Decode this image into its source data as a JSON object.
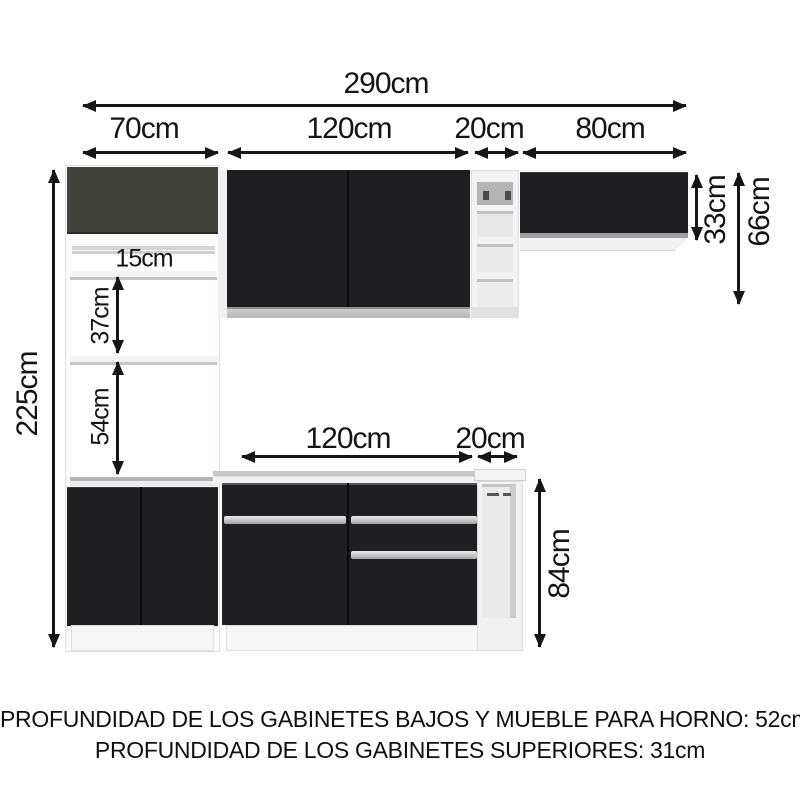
{
  "dims": {
    "total_width": "290cm",
    "tall_cabinet_width": "70cm",
    "wall_cabinet_width": "120cm",
    "upper_shelf_width": "20cm",
    "right_cabinet_width": "80cm",
    "total_height": "225cm",
    "right_cabinet_height": "33cm",
    "upper_zone_height": "66cm",
    "shelf_gap_top": "15cm",
    "shelf_gap_mid": "37cm",
    "shelf_gap_bottom": "54cm",
    "base_cabinet_width": "120cm",
    "base_shelf_width": "20cm",
    "base_height": "84cm"
  },
  "notes": {
    "line1": "PROFUNDIDAD DE LOS GABINETES BAJOS Y MUEBLE PARA HORNO: 52cm",
    "line2": "PROFUNDIDAD DE LOS GABINETES SUPERIORES: 31cm"
  },
  "colors": {
    "door_black": "#1f1f21",
    "oven_cabinet_gray": "#41423c",
    "trim_silver": "#c6c6c6",
    "dimension_line": "#161616"
  }
}
